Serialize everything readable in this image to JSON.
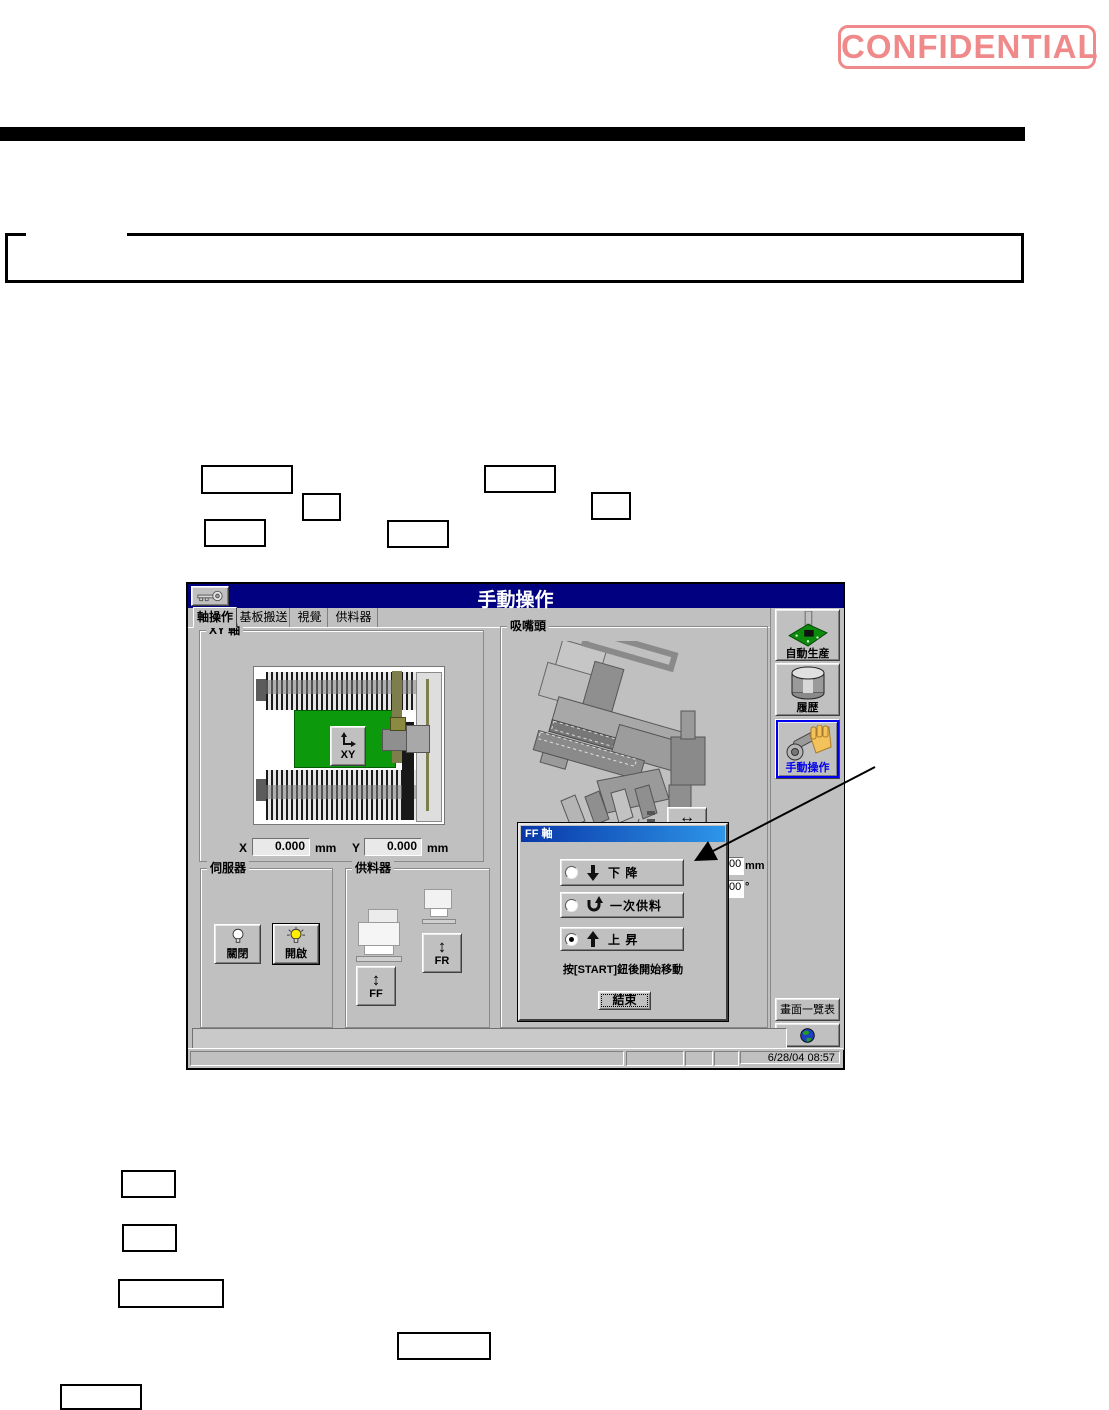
{
  "page": {
    "confidential_stamp": "CONFIDENTIAL"
  },
  "ui": {
    "title": "手動操作",
    "tabs": [
      {
        "label": "軸操作",
        "active": true
      },
      {
        "label": "基板搬送",
        "active": false
      },
      {
        "label": "視覺",
        "active": false
      },
      {
        "label": "供料器",
        "active": false
      }
    ],
    "xy_panel": {
      "label": "XY 軸",
      "xy_button_label": "XY",
      "x_label": "X",
      "x_value": "0.000",
      "x_unit": "mm",
      "y_label": "Y",
      "y_value": "0.000",
      "y_unit": "mm"
    },
    "head_panel": {
      "label": "吸嘴頭",
      "swap_button_glyph": "↔"
    },
    "servo_panel": {
      "label": "伺服器",
      "off_button": "關閉",
      "on_button": "開啟"
    },
    "feeder_panel": {
      "label": "供料器",
      "ff_button": "FF",
      "fr_button": "FR",
      "updown_glyph": "↕"
    },
    "ff_dialog": {
      "title": "FF 軸",
      "options": [
        {
          "label": "下 降",
          "selected": false
        },
        {
          "label": "一次供料",
          "selected": false
        },
        {
          "label": "上 昇",
          "selected": true
        }
      ],
      "hint": "按[START]鈕後開始移動",
      "end_button": "結束",
      "clipped_fields": [
        {
          "value": "00",
          "unit": "mm"
        },
        {
          "value": "00",
          "unit": "°"
        }
      ]
    },
    "sidebar": {
      "auto_production": "自動生産",
      "history": "履歴",
      "manual_operation": "手動操作",
      "screen_list": "畫面一覽表"
    },
    "statusbar": {
      "datetime": "6/28/04 08:57"
    }
  },
  "colors": {
    "title_bar": "#000080",
    "confidential": "#f08989",
    "pcb_green": "#0c9a0c",
    "selected_blue": "#0000ee",
    "dialog_title_gradient": [
      "#0837a8",
      "#2e96e8"
    ]
  }
}
